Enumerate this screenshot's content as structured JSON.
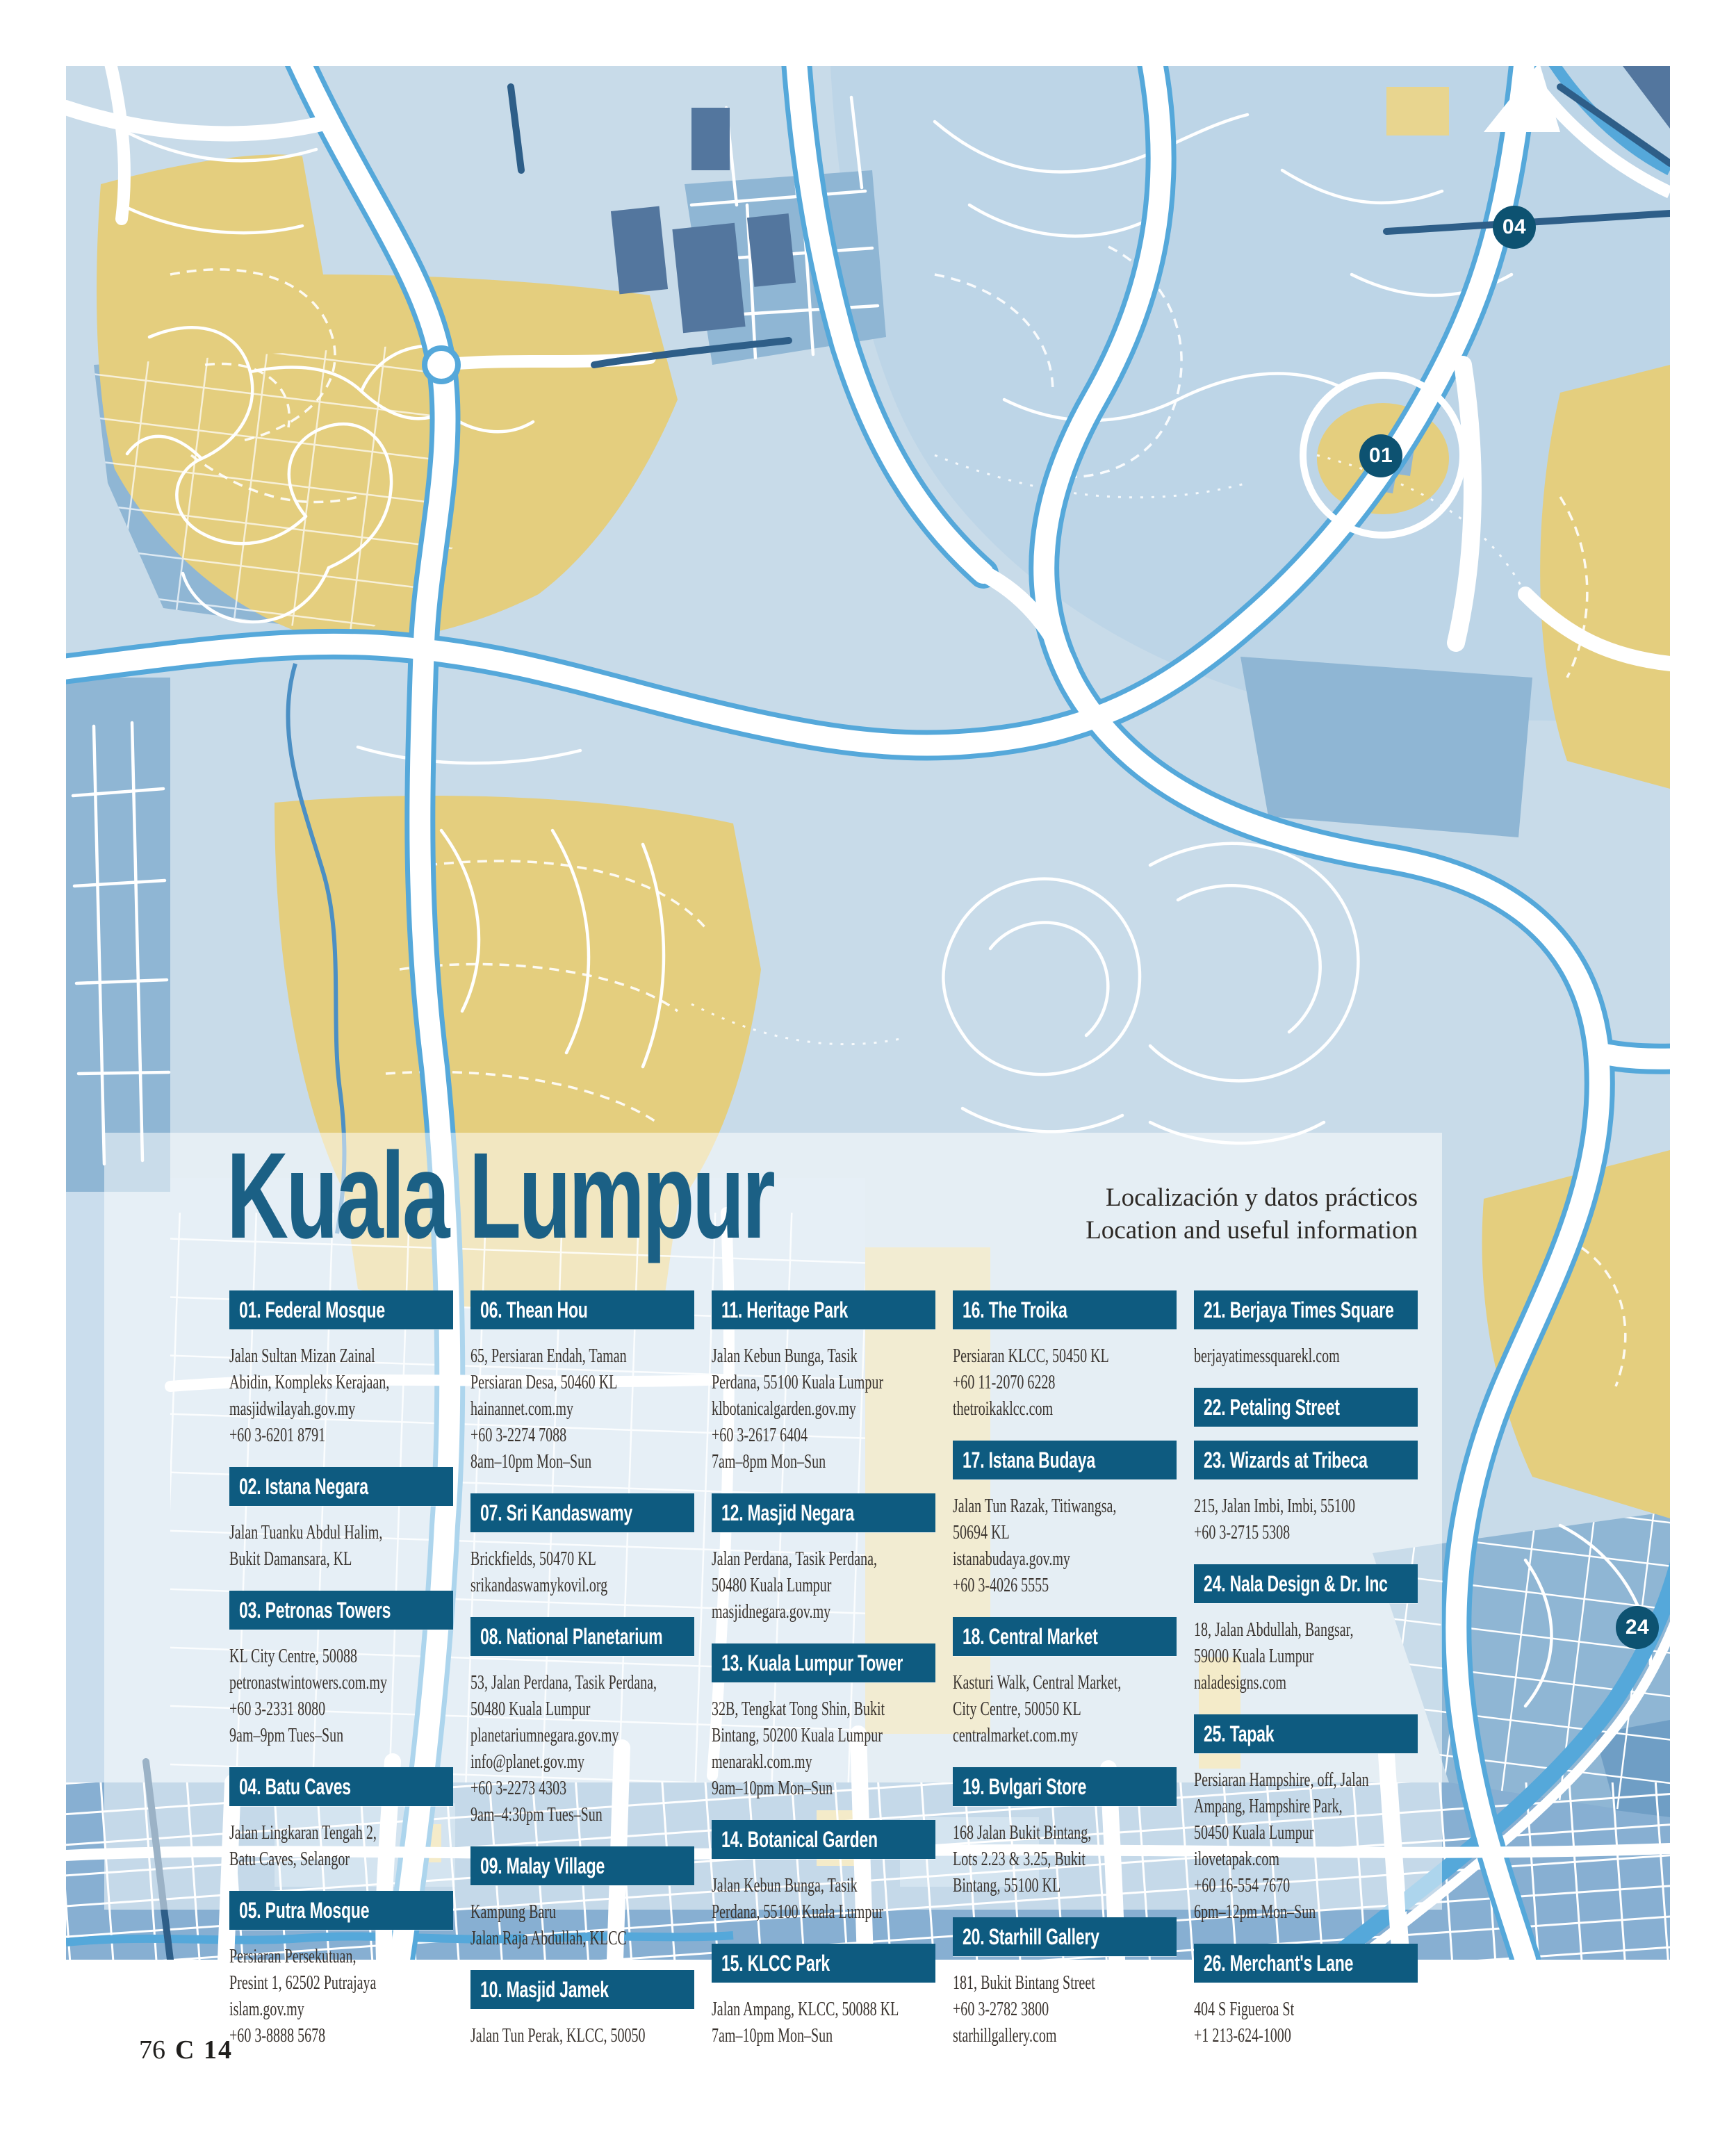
{
  "page": {
    "title": "Kuala Lumpur",
    "subtitle_es": "Localización y datos prácticos",
    "subtitle_en": "Location and useful information",
    "footer": {
      "page_number": "76",
      "section_code": "C 14"
    }
  },
  "map": {
    "city": "Kuala Lumpur",
    "markers": [
      {
        "label": "04"
      },
      {
        "label": "01"
      },
      {
        "label": "24"
      }
    ],
    "colors": {
      "base_blue": "#c8dbe9",
      "mid_blue": "#8fb6d4",
      "dense_band_blue": "#87afd2",
      "hill_yellow": "#e4ce7e",
      "road_casing_blue": "#55a8da",
      "dark_road_navy": "#2e5e88",
      "chip_teal": "#0e5b80",
      "marker_teal": "#0d5271",
      "title_teal": "#1b6085"
    }
  },
  "columns": [
    {
      "items": [
        {
          "label": "01. Federal Mosque",
          "details": "Jalan Sultan Mizan Zainal\nAbidin, Kompleks Kerajaan,\nmasjidwilayah.gov.my\n+60 3-6201 8791"
        },
        {
          "label": "02. Istana Negara",
          "details": "Jalan Tuanku Abdul Halim,\nBukit Damansara, KL"
        },
        {
          "label": "03. Petronas Towers",
          "details": "KL City Centre, 50088\npetronastwintowers.com.my\n+60 3-2331 8080\n9am–9pm Tues–Sun"
        },
        {
          "label": "04. Batu Caves",
          "details": "Jalan Lingkaran Tengah 2,\nBatu Caves, Selangor"
        },
        {
          "label": "05. Putra Mosque",
          "details": "Persiaran Persekutuan,\nPresint 1, 62502 Putrajaya\nislam.gov.my\n+60 3-8888 5678"
        }
      ]
    },
    {
      "items": [
        {
          "label": "06. Thean Hou",
          "details": "65, Persiaran Endah, Taman\nPersiaran Desa, 50460 KL\nhainannet.com.my\n+60 3-2274 7088\n8am–10pm Mon–Sun"
        },
        {
          "label": "07. Sri Kandaswamy",
          "details": "Brickfields, 50470 KL\nsrikandaswamykovil.org"
        },
        {
          "label": "08. National Planetarium",
          "details": "53, Jalan Perdana, Tasik Perdana,\n50480 Kuala Lumpur\nplanetariumnegara.gov.my\ninfo@planet.gov.my\n+60 3-2273 4303\n9am–4:30pm Tues–Sun"
        },
        {
          "label": "09. Malay Village",
          "details": "Kampung Baru\nJalan Raja Abdullah, KLCC"
        },
        {
          "label": "10. Masjid Jamek",
          "details": "Jalan Tun Perak, KLCC, 50050"
        }
      ]
    },
    {
      "items": [
        {
          "label": "11. Heritage Park",
          "details": "Jalan Kebun Bunga, Tasik\nPerdana, 55100 Kuala Lumpur\nklbotanicalgarden.gov.my\n+60 3-2617 6404\n7am–8pm Mon–Sun"
        },
        {
          "label": "12. Masjid Negara",
          "details": "Jalan Perdana, Tasik Perdana,\n50480 Kuala Lumpur\nmasjidnegara.gov.my"
        },
        {
          "label": "13. Kuala Lumpur Tower",
          "details": "32B, Tengkat Tong Shin, Bukit\nBintang, 50200 Kuala Lumpur\nmenarakl.com.my\n9am–10pm Mon–Sun"
        },
        {
          "label": "14. Botanical Garden",
          "details": "Jalan Kebun Bunga, Tasik\nPerdana, 55100 Kuala Lumpur"
        },
        {
          "label": "15. KLCC Park",
          "details": "Jalan Ampang, KLCC, 50088 KL\n7am–10pm Mon–Sun"
        }
      ]
    },
    {
      "items": [
        {
          "label": "16. The Troika",
          "details": "Persiaran KLCC, 50450 KL\n+60 11-2070 6228\nthetroikaklcc.com"
        },
        {
          "label": "17. Istana Budaya",
          "details": "Jalan Tun Razak, Titiwangsa,\n50694 KL\nistanabudaya.gov.my\n+60 3-4026 5555"
        },
        {
          "label": "18. Central Market",
          "details": "Kasturi Walk, Central Market,\nCity Centre, 50050 KL\ncentralmarket.com.my"
        },
        {
          "label": "19. Bvlgari Store",
          "details": "168 Jalan Bukit Bintang,\nLots 2.23 & 3.25, Bukit\nBintang, 55100 KL"
        },
        {
          "label": "20. Starhill Gallery",
          "details": "181, Bukit Bintang Street\n+60 3-2782 3800\nstarhillgallery.com"
        }
      ]
    },
    {
      "items": [
        {
          "label": "21. Berjaya Times Square",
          "details": "berjayatimessquarekl.com"
        },
        {
          "label": "22. Petaling Street",
          "details": ""
        },
        {
          "label": "23. Wizards at Tribeca",
          "details": "215, Jalan Imbi, Imbi, 55100\n+60 3-2715 5308"
        },
        {
          "label": "24. Nala Design & Dr. Inc",
          "details": "18, Jalan Abdullah, Bangsar,\n59000 Kuala Lumpur\nnaladesigns.com"
        },
        {
          "label": "25. Tapak",
          "details": "Persiaran Hampshire, off, Jalan\nAmpang, Hampshire Park,\n50450 Kuala Lumpur\nilovetapak.com\n+60 16-554 7670\n6pm–12pm Mon–Sun"
        },
        {
          "label": "26. Merchant's Lane",
          "details": "404 S Figueroa St\n+1 213-624-1000"
        }
      ]
    }
  ]
}
